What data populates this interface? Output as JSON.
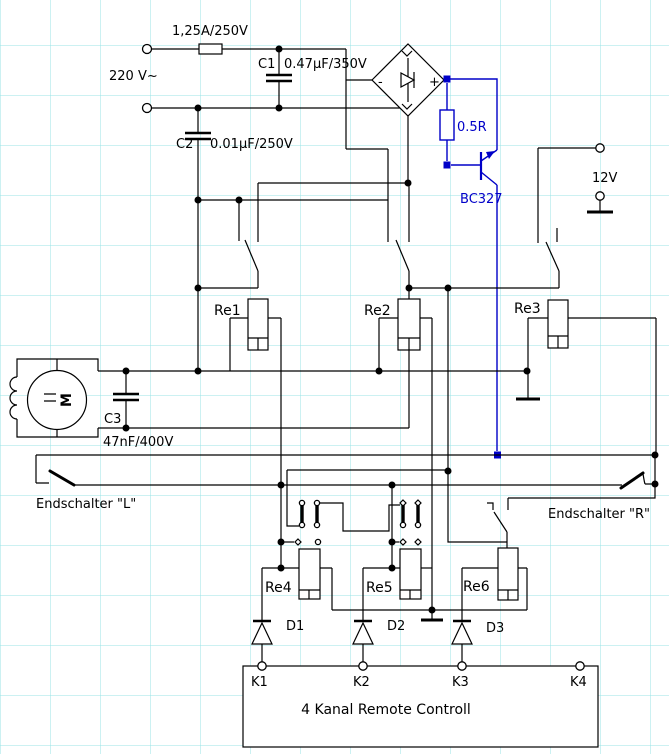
{
  "colors": {
    "wire": "#000000",
    "accent_blue": "#0000C8",
    "grid": "#98E3E5",
    "background": "#FFFFFF"
  },
  "schematic": {
    "fuse": "1,25A/250V",
    "mains": "220 V~",
    "c1": "C1",
    "c1_value": "0.47µF/350V",
    "c2": "C2",
    "c2_value": "0.01µF/250V",
    "c3": "C3",
    "c3_value": "47nF/400V",
    "resistor": "0.5R",
    "transistor": "BC327",
    "supply": "12V",
    "bridge_plus": "+",
    "bridge_minus": "-",
    "motor": "M",
    "relay1": "Re1",
    "relay2": "Re2",
    "relay3": "Re3",
    "relay4": "Re4",
    "relay5": "Re5",
    "relay6": "Re6",
    "limit_switch_left": "Endschalter \"L\"",
    "limit_switch_right": "Endschalter \"R\"",
    "diode1": "D1",
    "diode2": "D2",
    "diode3": "D3",
    "k1": "K1",
    "k2": "K2",
    "k3": "K3",
    "k4": "K4",
    "receiver_box": "4 Kanal Remote Controll"
  }
}
